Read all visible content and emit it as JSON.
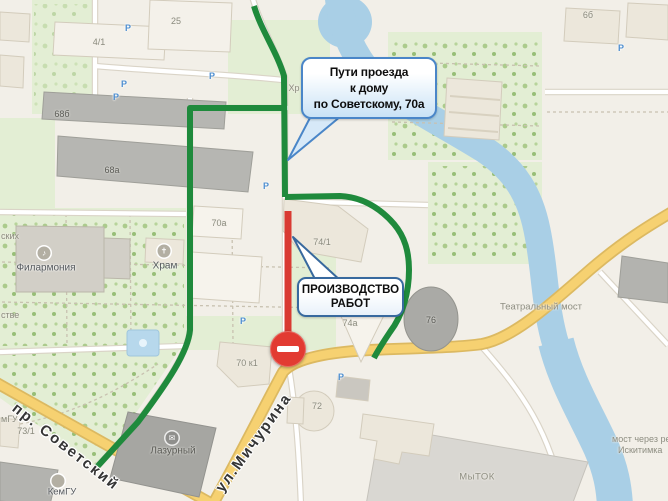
{
  "app": {
    "type": "map-annotation",
    "city_context": "route scheme on city map"
  },
  "callouts": {
    "route": {
      "line1": "Пути проезда",
      "line2": "к дому",
      "line3": "по Советскому, 70а"
    },
    "roadwork": {
      "line1": "ПРОИЗВОДСТВО",
      "line2": "РАБОТ"
    }
  },
  "streets": {
    "sovetsky": "пр. Советский",
    "michurina": "ул.Мичурина"
  },
  "places": {
    "philharmonic": "Филармония",
    "temple": "Храм",
    "lazurny": "Лазурный",
    "kemgu": "КемГУ",
    "mytok": "МыТОК",
    "theatre_bridge": "Театральный мост",
    "river_bridge_line1": "мост через ре",
    "river_bridge_line2": "Искитимка"
  },
  "buildings": {
    "b25": "25",
    "b4_1": "4/1",
    "b6b": "6б",
    "b68b": "68б",
    "b68a": "68а",
    "b70a": "70а",
    "b74_1": "74/1",
    "b74a": "74а",
    "b76": "76",
    "b70k1": "70 к1",
    "b72": "72",
    "b73_1": "73/1"
  },
  "partials": {
    "left_top": "ских",
    "left_mid": "стве",
    "left_gu": "мГУ",
    "center": "Хр"
  },
  "icons": {
    "parking": "P",
    "philharmonic": "♪",
    "temple": "✝",
    "lazurny": "✉",
    "no_entry": "no-entry"
  },
  "colors": {
    "route_open": "#1f8a3c",
    "route_closed": "#d93a32",
    "water": "#a9cfe6",
    "main_road": "#f6d171",
    "park": "#e3eed4",
    "callout_border": "#4a86c8",
    "callout_fill": "#c9e2f6"
  }
}
